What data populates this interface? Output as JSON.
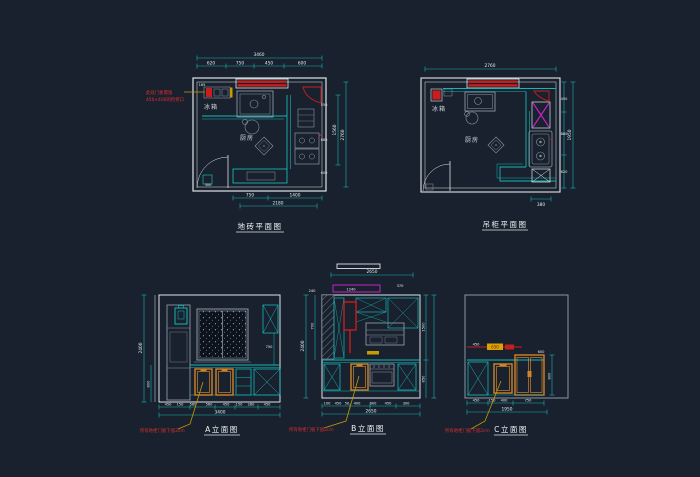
{
  "colors": {
    "background": "#18212d",
    "line_white": "#dfe4e9",
    "line_gray": "#8b97a2",
    "teal": "#16b6b6",
    "red": "#c81e1e",
    "orange": "#d08428",
    "yellow": "#c89b00",
    "magenta": "#c322c3"
  },
  "plan_floor": {
    "title": "地砖平面图",
    "fridge_label": "冰箱",
    "room_label": "厨房",
    "note_line1": "此处门板需留",
    "note_line2": "450×400的检修口",
    "dims": {
      "top_overall": "3460",
      "top_row": [
        "620",
        "750",
        "450",
        "600"
      ],
      "wall_right": [
        "550",
        "880",
        "600"
      ],
      "right_inner_overall": "1560",
      "right_overall": "2760",
      "bottom_row": [
        "750",
        "1400"
      ],
      "bottom_overall": "2180",
      "small_a": "165",
      "small_b": "300"
    }
  },
  "plan_cabinet": {
    "title": "吊柜平面图",
    "fridge_label": "冰箱",
    "room_label": "厨房",
    "dims": {
      "top_overall": "2760",
      "right_segments": [
        "450",
        "880",
        "620"
      ],
      "right_overall": "1950",
      "bottom_small": "380"
    }
  },
  "elev_a": {
    "title": "A立面图",
    "note": "所有地柜门板下留2cm",
    "dims": {
      "left_overall": "2400",
      "left_lower": "800",
      "mid": "750",
      "bottom_row": [
        "450",
        "150",
        "560",
        "560",
        "450",
        "150",
        "280",
        "450"
      ],
      "bottom_overall": "3400"
    }
  },
  "elev_b": {
    "title": "B立面图",
    "note": "所有地柜门板下留2cm",
    "dims": {
      "top_overall": "2650",
      "band_row": [
        "240",
        "1240",
        "370"
      ],
      "left_overall": "2400",
      "left_upper": "700",
      "right_upper": "1500",
      "right_lower": "850",
      "bottom_row": [
        "100",
        "450",
        "50",
        "400",
        "600",
        "450",
        "300"
      ],
      "bottom_overall": "2650"
    }
  },
  "elev_c": {
    "title": "C立面图",
    "note": "所有地柜门板下留2cm",
    "dims": {
      "line_dim": "450",
      "band_label": "650",
      "upper": "600",
      "side": "800",
      "bottom_row": [
        "450",
        "150",
        "400",
        "750"
      ],
      "bottom_overall": "1950"
    }
  }
}
